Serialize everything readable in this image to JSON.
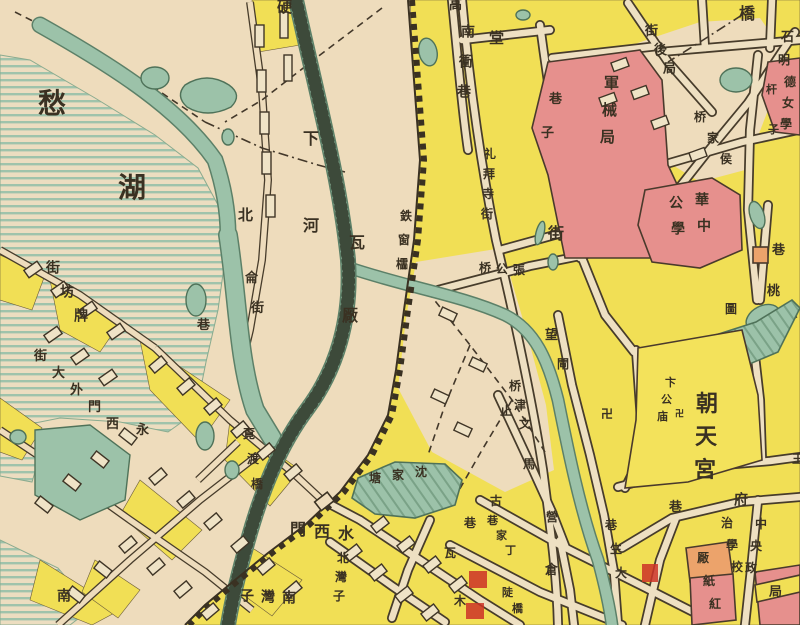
{
  "map": {
    "description": "Historical Chinese city map detail (Nanjing area around Mochou Lake, Shuixi Gate and Chaotian Gong)",
    "colors": {
      "paper": "#eedcbc",
      "water": "#9cc2a9",
      "built_block_yellow": "#f1df55",
      "institution_pink": "#e6908d",
      "institution_orange": "#eca36b",
      "overprint_red": "#cc3327",
      "ink": "#3a3122"
    },
    "labels": [
      {
        "name": "mochou-lake-chou",
        "text": "愁",
        "x": 38,
        "y": 92,
        "size": 28
      },
      {
        "name": "mochou-lake-hu",
        "text": "湖",
        "x": 118,
        "y": 176,
        "size": 28
      },
      {
        "name": "ying-top-edge",
        "text": "硬",
        "x": 277,
        "y": 1,
        "size": 15
      },
      {
        "name": "xiahe-xia",
        "text": "下",
        "x": 303,
        "y": 132,
        "size": 16
      },
      {
        "name": "xiahe-he",
        "text": "河",
        "x": 303,
        "y": 219,
        "size": 16
      },
      {
        "name": "bei-riverbank",
        "text": "北",
        "x": 238,
        "y": 209,
        "size": 15
      },
      {
        "name": "lun-westbank",
        "text": "侖",
        "x": 245,
        "y": 273,
        "size": 13
      },
      {
        "name": "jie-westbank",
        "text": "街",
        "x": 251,
        "y": 303,
        "size": 13
      },
      {
        "name": "xiang-westbank",
        "text": "巷",
        "x": 197,
        "y": 320,
        "size": 13
      },
      {
        "name": "paifang-jie",
        "text": "街坊牌",
        "x": 46,
        "y": 263,
        "dx": 14,
        "dy": 24,
        "size": 14
      },
      {
        "name": "ximenwai-dajie",
        "text": "街大外門西",
        "x": 34,
        "y": 351,
        "dx": 18,
        "dy": 17,
        "size": 13
      },
      {
        "name": "yong-westbank",
        "text": "永",
        "x": 136,
        "y": 425,
        "size": 13
      },
      {
        "name": "midu-qiao",
        "text": "覔渡橋",
        "x": 243,
        "y": 429,
        "dx": 4,
        "dy": 25,
        "size": 12,
        "color": "#23392c"
      },
      {
        "name": "nan-bottom-left",
        "text": "南",
        "x": 57,
        "y": 591,
        "size": 14
      },
      {
        "name": "nanwanzi",
        "text": "子灣南",
        "x": 240,
        "y": 591,
        "dx": 21,
        "dy": 1,
        "size": 14
      },
      {
        "name": "beiwanzi",
        "text": "北灣子",
        "x": 337,
        "y": 553,
        "dx": -2,
        "dy": 19,
        "size": 12
      },
      {
        "name": "shuiximen-gate",
        "text": "門西水",
        "x": 290,
        "y": 523,
        "dx": 24,
        "dy": 2,
        "size": 16
      },
      {
        "name": "wachang",
        "text": "瓦厰",
        "x": 349,
        "y": 236,
        "dx": -7,
        "dy": 73,
        "size": 16
      },
      {
        "name": "tiechuangling",
        "text": "鉄窗櫺",
        "x": 400,
        "y": 211,
        "dx": -2,
        "dy": 24,
        "size": 12
      },
      {
        "name": "gao-top-edge",
        "text": "高",
        "x": 449,
        "y": 0,
        "size": 13
      },
      {
        "name": "nanchong-xiang",
        "text": "南衝巷",
        "x": 461,
        "y": 27,
        "dx": -2,
        "dy": 30,
        "size": 14
      },
      {
        "name": "tang",
        "text": "堂",
        "x": 489,
        "y": 32,
        "size": 15
      },
      {
        "name": "libaisi-jie",
        "text": "礼拜寺街",
        "x": 484,
        "y": 149,
        "dx": -1,
        "dy": 20,
        "size": 12
      },
      {
        "name": "junxieju-xiangzi",
        "text": "巷子",
        "x": 549,
        "y": 94,
        "dx": -8,
        "dy": 34,
        "size": 13
      },
      {
        "name": "junxieju-arsenal",
        "text": "軍械局",
        "x": 604,
        "y": 77,
        "dx": -2,
        "dy": 27,
        "size": 15
      },
      {
        "name": "jie-center",
        "text": "街",
        "x": 548,
        "y": 227,
        "size": 16
      },
      {
        "name": "zhanggong-qiao",
        "text": "桥公張",
        "x": 479,
        "y": 263,
        "dx": 17,
        "dy": 1,
        "size": 12
      },
      {
        "name": "wang-char",
        "text": "望",
        "x": 545,
        "y": 330,
        "size": 13
      },
      {
        "name": "zha-char",
        "text": "閘",
        "x": 557,
        "y": 359,
        "size": 12
      },
      {
        "name": "wenjin-qiao",
        "text": "桥津文",
        "x": 509,
        "y": 381,
        "dx": 5,
        "dy": 19,
        "size": 12
      },
      {
        "name": "zhimaying",
        "text": "止馬營",
        "x": 500,
        "y": 406,
        "dx": 23,
        "dy": 53,
        "size": 12
      },
      {
        "name": "temple-swastika-1",
        "text": "卍",
        "x": 601,
        "y": 409,
        "size": 12
      },
      {
        "name": "biangong-ci",
        "text": "卞公庙",
        "x": 665,
        "y": 378,
        "dx": -4,
        "dy": 17,
        "size": 11
      },
      {
        "name": "temple-swastika-2",
        "text": "卍",
        "x": 675,
        "y": 411,
        "size": 9
      },
      {
        "name": "chaotiangong",
        "text": "朝天宮",
        "x": 696,
        "y": 396,
        "dx": -1,
        "dy": 33,
        "size": 22
      },
      {
        "name": "tao-char",
        "text": "桃",
        "x": 767,
        "y": 286,
        "size": 13
      },
      {
        "name": "xiang-northeast",
        "text": "巷",
        "x": 772,
        "y": 245,
        "size": 13
      },
      {
        "name": "tu-char",
        "text": "圖",
        "x": 725,
        "y": 304,
        "size": 12
      },
      {
        "name": "juhou-jie",
        "text": "街後局",
        "x": 645,
        "y": 26,
        "dx": 9,
        "dy": 19,
        "size": 13
      },
      {
        "name": "qiao-top-right",
        "text": "橋",
        "x": 739,
        "y": 7,
        "size": 16
      },
      {
        "name": "houjia-qiao",
        "text": "桥家侯",
        "x": 694,
        "y": 112,
        "dx": 13,
        "dy": 21,
        "size": 12
      },
      {
        "name": "shi-edge",
        "text": "石",
        "x": 781,
        "y": 32,
        "size": 13
      },
      {
        "name": "ming-edge",
        "text": "明",
        "x": 778,
        "y": 55,
        "size": 12
      },
      {
        "name": "mingde-girls-school",
        "text": "德女學",
        "x": 784,
        "y": 77,
        "dx": -2,
        "dy": 21,
        "size": 12
      },
      {
        "name": "ganzi-street",
        "text": "杆子",
        "x": 766,
        "y": 85,
        "dx": 2,
        "dy": 40,
        "size": 11
      },
      {
        "name": "huazhong-gongxue-col1",
        "text": "華中",
        "x": 695,
        "y": 195,
        "dx": 2,
        "dy": 26,
        "size": 14
      },
      {
        "name": "huazhong-gongxue-col2",
        "text": "公學",
        "x": 669,
        "y": 198,
        "dx": 2,
        "dy": 26,
        "size": 14
      },
      {
        "name": "fu-char",
        "text": "府",
        "x": 734,
        "y": 495,
        "size": 14
      },
      {
        "name": "xiang-fu",
        "text": "巷",
        "x": 669,
        "y": 502,
        "size": 13
      },
      {
        "name": "central-political-school-col1",
        "text": "中央政",
        "x": 755,
        "y": 519,
        "dx": -5,
        "dy": 22,
        "size": 12
      },
      {
        "name": "central-political-school-col2",
        "text": "治學校",
        "x": 721,
        "y": 518,
        "dx": 5,
        "dy": 22,
        "size": 12
      },
      {
        "name": "hongzhi-chang",
        "text": "厰紙紅",
        "x": 697,
        "y": 553,
        "dx": 6,
        "dy": 23,
        "size": 12
      },
      {
        "name": "ju-block",
        "text": "局",
        "x": 769,
        "y": 587,
        "size": 13
      },
      {
        "name": "gu-char",
        "text": "古",
        "x": 490,
        "y": 496,
        "size": 12
      },
      {
        "name": "dingjia-xiang",
        "text": "巷家丁",
        "x": 487,
        "y": 516,
        "dx": 9,
        "dy": 15,
        "size": 11
      },
      {
        "name": "cang-char",
        "text": "倉",
        "x": 545,
        "y": 565,
        "size": 13
      },
      {
        "name": "dasheng-xiang",
        "text": "巷生大",
        "x": 605,
        "y": 520,
        "dx": 5,
        "dy": 24,
        "size": 12
      },
      {
        "name": "dou-qiao",
        "text": "陡橋",
        "x": 502,
        "y": 588,
        "dx": 10,
        "dy": 16,
        "size": 11
      },
      {
        "name": "xiang-center-south",
        "text": "巷",
        "x": 464,
        "y": 518,
        "size": 12
      },
      {
        "name": "wa-center-south",
        "text": "瓦",
        "x": 444,
        "y": 548,
        "size": 12
      },
      {
        "name": "mu-center-south",
        "text": "木",
        "x": 454,
        "y": 596,
        "size": 12
      },
      {
        "name": "shenjiatang-pond",
        "text": "塘家沈",
        "x": 369,
        "y": 473,
        "dx": 23,
        "dy": -3,
        "size": 12,
        "color": "#23392c"
      },
      {
        "name": "wang-right-edge",
        "text": "王",
        "x": 792,
        "y": 454,
        "size": 12
      }
    ],
    "features": [
      "mochou-lake",
      "city-wall",
      "shuixi-gate",
      "moat-river",
      "railway-embankment",
      "yundu-canal",
      "shenjiatang-pond",
      "chaotiangong-block",
      "arsenal-block",
      "huazhong-public-school-block",
      "mingde-girls-school-block",
      "red-paper-mill-block"
    ]
  }
}
